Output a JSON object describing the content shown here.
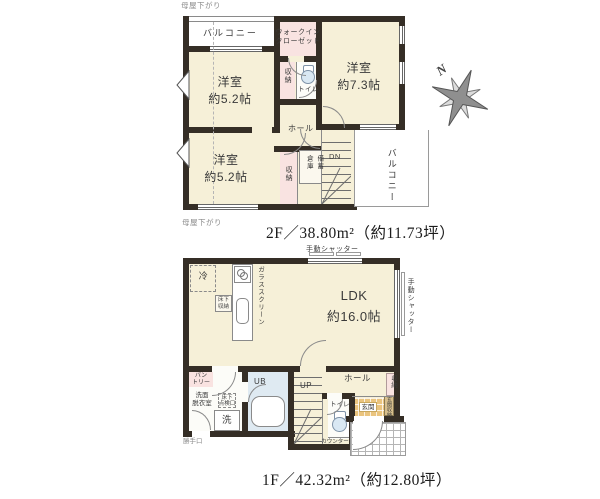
{
  "colors": {
    "wall": "#352e26",
    "room": "#f6f0d8",
    "closet": "#f9e3e1",
    "bath": "#dfeaf2",
    "toiletfill": "#d9e8f3",
    "genkan": "#eac47e",
    "shoebox": "#d7bf8d"
  },
  "compass": {
    "label": "N"
  },
  "floor2": {
    "title": "2F／38.80m²（約11.73坪）",
    "attic_note_top": "母屋下がり",
    "attic_note_bottom": "母屋下がり",
    "balcony_top": "バルコニー",
    "balcony_right": "バルコニー",
    "walk_in_closet": "ウォークイン\nクローゼット",
    "bedroom_ne": "洋室\n約7.3帖",
    "bedroom_nw": "洋室\n約5.2帖",
    "bedroom_sw": "洋室\n約5.2帖",
    "closet_north": "収納",
    "closet_south": "収納",
    "stock_storage": "備蓄\n倉庫",
    "toilet": "トイレ",
    "hall": "ホール",
    "stairs_down": "DN"
  },
  "floor1": {
    "title": "1F／42.32m²（約12.80坪）",
    "ldk": "LDK\n約16.0帖",
    "refrigerator": "冷",
    "glass_screen": "ガラススクリーン",
    "underfloor_storage": "床下\n収納",
    "shutter_top": "手動シャッター",
    "shutter_right": "手動シャッター",
    "pantry": "パン\nトリー",
    "washroom": "洗面\n脱衣室",
    "underfloor_hatch": "床下\n点検口",
    "washer": "洗",
    "unit_bath": "UB",
    "stairs_up": "UP",
    "toilet": "トイレ",
    "toilet_counter": "カウンター",
    "hall": "ホール",
    "hall_closet": "収納",
    "entrance": "玄関",
    "entrance_storage": "玄関収納",
    "back_door": "勝手口"
  }
}
